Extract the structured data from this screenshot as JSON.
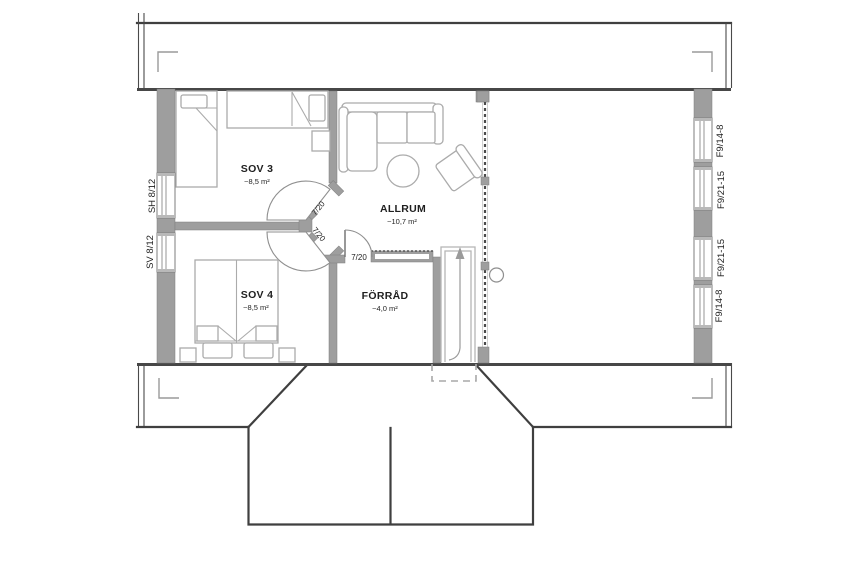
{
  "plan_type": "floor-plan-upper-storey",
  "rooms": {
    "sov3": {
      "name": "SOV 3",
      "area": "~8,5 m²"
    },
    "sov4": {
      "name": "SOV 4",
      "area": "~8,5 m²"
    },
    "allrum": {
      "name": "ALLRUM",
      "area": "~10,7 m²"
    },
    "forrad": {
      "name": "FÖRRÅD",
      "area": "~4,0 m²"
    }
  },
  "doors": {
    "sov3": "7/20",
    "sov4": "7/20",
    "forrad": "7/20"
  },
  "windows": {
    "left_top": "SH 8/12",
    "left_bottom": "SV 8/12",
    "right_1": "F9/14-8",
    "right_2": "F9/21-15",
    "right_3": "F9/21-15",
    "right_4": "F9/14-8"
  },
  "colors": {
    "background": "#ffffff",
    "wall_fill": "#9e9e9e",
    "roof_line": "#3f3f3f",
    "furniture_line": "#ababab",
    "text": "#1f1f1f"
  }
}
